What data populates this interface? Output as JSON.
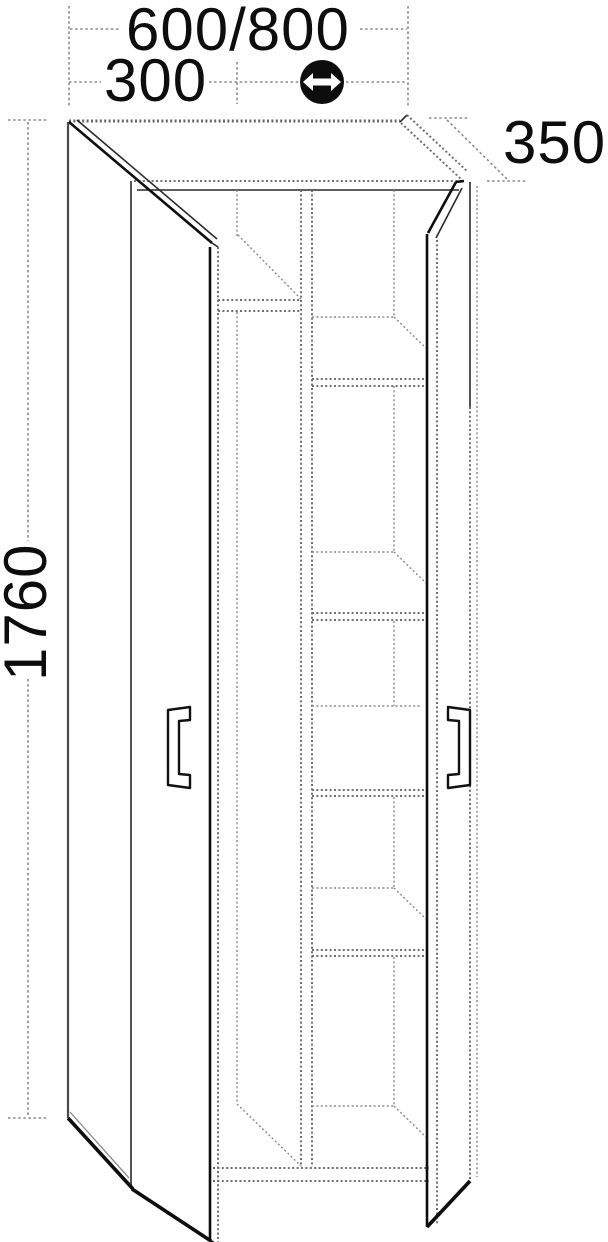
{
  "page": {
    "background": "#ffffff"
  },
  "drawing": {
    "type": "furniture-technical-line-drawing",
    "subject": "tall two-door cabinet with open doors, center divider and interior shelves",
    "projection": "oblique front view",
    "labels": {
      "width": "600/800",
      "left_compartment_width": "300",
      "depth": "350",
      "height": "1760"
    },
    "icons": [
      {
        "name": "horizontal-double-arrow-icon",
        "meaning": "variable width",
        "style": "white double-headed arrow in black circle"
      }
    ],
    "colors": {
      "solid_line": "#0d0d0d",
      "dotted_line": "#6f6f6f",
      "dimension_line": "#8a8a8a",
      "text": "#0d0d0d",
      "background": "#ffffff"
    }
  }
}
